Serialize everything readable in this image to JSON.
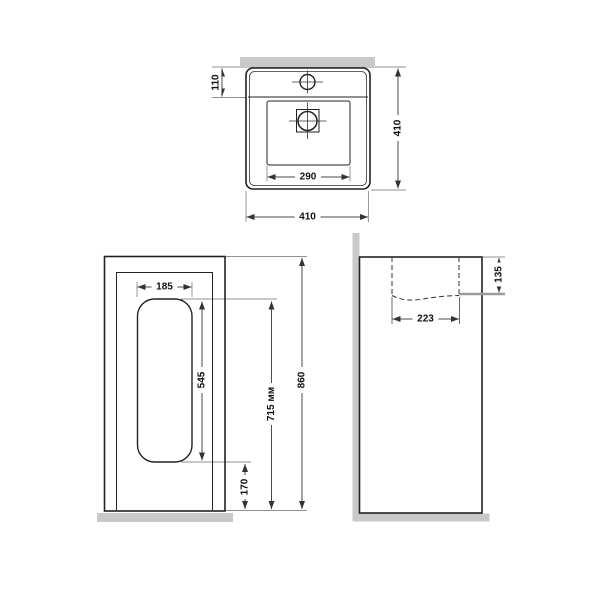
{
  "colors": {
    "line": "#222222",
    "dim_line": "#4a4a4a",
    "extension_line": "#8f8f8f",
    "surface_gray": "#c9c9c9",
    "background": "#ffffff"
  },
  "views": {
    "top": {
      "dims": {
        "overall_width": "410",
        "overall_depth": "410",
        "bowl_width": "290",
        "tap_deck_depth": "110"
      }
    },
    "front": {
      "dims": {
        "recess_width": "185",
        "recess_height": "545",
        "recess_floor_gap": "170",
        "recess_top_from_floor": "715 мм",
        "overall_height": "860"
      }
    },
    "side": {
      "dims": {
        "bowl_depth": "135",
        "bowl_inner_length": "223"
      }
    }
  }
}
